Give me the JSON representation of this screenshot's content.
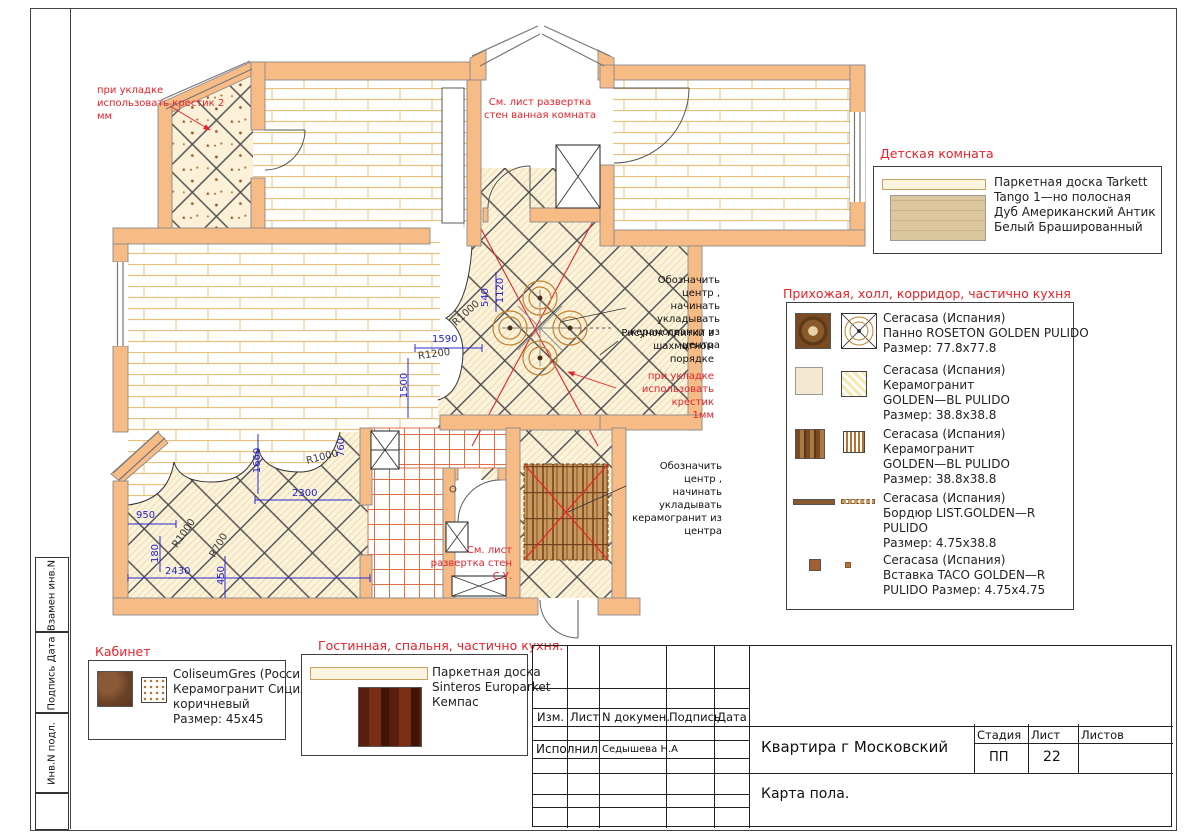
{
  "annotations": {
    "crosses2": "при укладке\nиспользовать крестик 2\nмм",
    "bath_note": "См. лист развертка\nстен ванная комната",
    "center1": "Обозначить центр ,\nначинать укладывать\nкерамогранит из\nцентра",
    "pattern_note": "Рисунок плитки в\nшахматном порядке",
    "crosses1": "при укладке\nиспользовать крестик\n1мм",
    "center2": "Обозначить центр ,\nначинать укладывать\nкерамогранит из\nцентра",
    "wc_note": "См. лист\nразвертка стен\nС.У."
  },
  "dims": [
    "1590",
    "R1200",
    "1500",
    "540",
    "1120",
    "R1000",
    "1660",
    "R1000",
    "760",
    "2300",
    "950",
    "R1000",
    "180",
    "R700",
    "2430",
    "450"
  ],
  "legends": {
    "kids": {
      "title": "Детская комната",
      "lines": [
        "Паркетная доска Tarkett",
        "Tango 1—но полосная",
        "Дуб Американский Антик",
        "Белый Брашированный"
      ]
    },
    "hall": {
      "title": "Прихожая, холл, корридор, частично кухня",
      "items": [
        {
          "lines": [
            "Ceracasa (Испания)",
            "Панно ROSETON GOLDEN PULIDO",
            "Размер: 77.8x77.8"
          ]
        },
        {
          "lines": [
            "Ceracasa (Испания)",
            "Керамогранит",
            "GOLDEN—BL PULIDO",
            "Размер: 38.8x38.8"
          ]
        },
        {
          "lines": [
            "Ceracasa (Испания)",
            "Керамогранит",
            "GOLDEN—BL PULIDO",
            "Размер: 38.8x38.8"
          ]
        },
        {
          "lines": [
            "Ceracasa (Испания)",
            "Бордюр LIST.GOLDEN—R",
            "PULIDO",
            "Размер: 4.75x38.8"
          ]
        },
        {
          "lines": [
            "Ceracasa (Испания)",
            "Вставка TACO GOLDEN—R",
            "PULIDO Размер: 4.75x4.75"
          ]
        }
      ]
    },
    "cabinet": {
      "title": "Кабинет",
      "lines": [
        "ColiseumGres (Россия)",
        "Керамогранит Сицилия",
        "коричневый",
        "Размер: 45x45"
      ]
    },
    "living": {
      "title": "Гостинная, спальня, частично кухня.",
      "lines": [
        "Паркетная доска",
        "Sinteros Europarket",
        "Кемпас"
      ]
    }
  },
  "titleblock": {
    "cols": [
      "Изм.",
      "Лист",
      "N докумен.",
      "Подпись",
      "Дата"
    ],
    "executor_label": "Исполнил",
    "executor": "Седышева Н.А",
    "project": "Квартира г Московский",
    "doc_title": "Карта пола.",
    "stage_label": "Стадия",
    "sheet_label": "Лист",
    "sheets_label": "Листов",
    "stage": "ПП",
    "sheet": "22"
  },
  "side_strip": [
    "Взамен инв.N",
    "Подпись Дата",
    "Инв.N подл."
  ]
}
